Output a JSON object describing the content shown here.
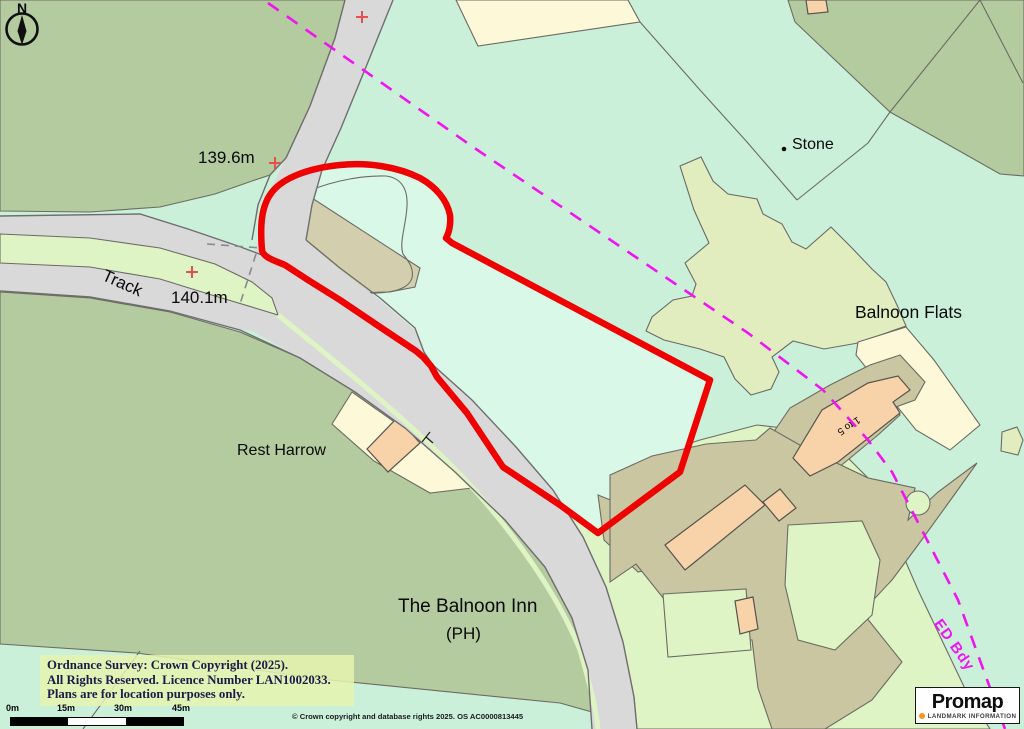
{
  "map": {
    "compass": {
      "label": "N"
    },
    "labels": {
      "elevation_1": "139.6m",
      "elevation_2": "140.1m",
      "track": "Track",
      "rest_harrow": "Rest Harrow",
      "balnoon_inn": "The Balnoon Inn",
      "balnoon_inn_type": "(PH)",
      "stone": "Stone",
      "balnoon_flats": "Balnoon Flats",
      "flats_numbers": "1 to 5",
      "ed_boundary": "ED Bdy"
    }
  },
  "footer": {
    "copyright_line1": "Ordnance Survey: Crown Copyright (2025).",
    "copyright_line2": "All Rights Reserved. Licence Number LAN1002033.",
    "copyright_line3": "Plans are for location purposes only.",
    "scale_ticks": {
      "t0": "0m",
      "t1": "15m",
      "t2": "30m",
      "t3": "45m"
    },
    "os_attribution": "© Crown copyright and database rights 2025. OS AC0000813445",
    "promap_brand": "Promap",
    "promap_sub": "LANDMARK INFORMATION"
  },
  "colors": {
    "mint": "#cbf0da",
    "field": "#d9f8e7",
    "olive": "#b4cb9f",
    "lightgreen": "#dff4c5",
    "chartreuse": "#e1edbf",
    "khaki": "#c9c6a1",
    "tan": "#d3cfae",
    "cream": "#fdf8d8",
    "peach": "#f8d2a9",
    "road": "#d9d9d9",
    "road_edge": "#6e6e6e",
    "parcel_edge": "#6b6b64",
    "red": "#ee0202",
    "magenta": "#f014f0",
    "marker": "#e85050",
    "promap_orange": "#f7941d",
    "copyright": "#1b1b4a"
  }
}
